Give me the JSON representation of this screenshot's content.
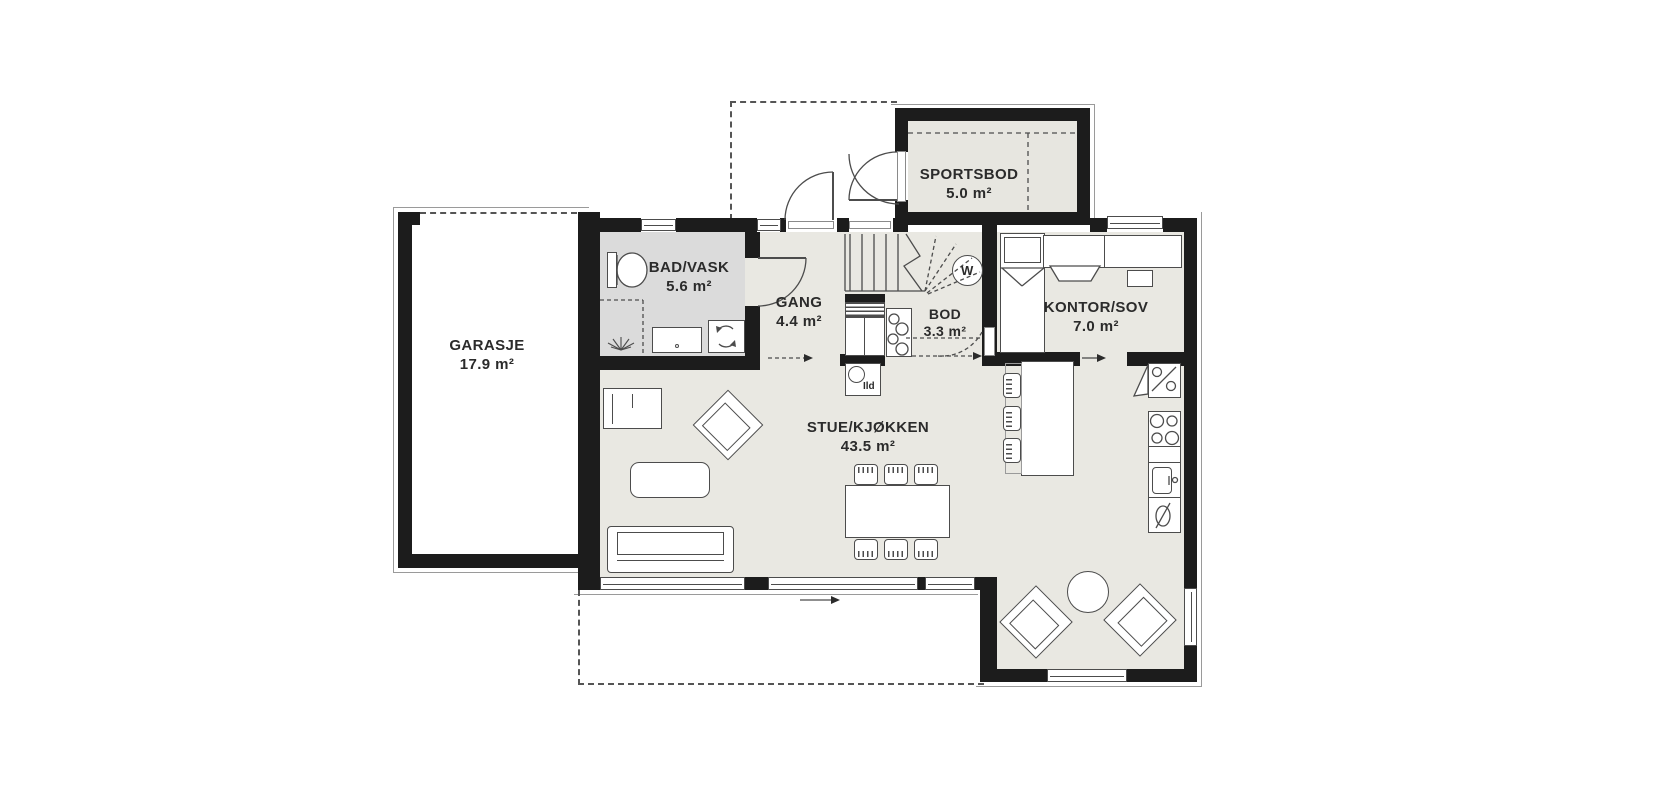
{
  "plan": {
    "title": "floor-plan-first-floor",
    "rooms": [
      {
        "key": "garasje",
        "name": "GARASJE",
        "area": "17.9 m²"
      },
      {
        "key": "sportsbod",
        "name": "SPORTSBOD",
        "area": "5.0 m²"
      },
      {
        "key": "bad_vask",
        "name": "BAD/VASK",
        "area": "5.6 m²"
      },
      {
        "key": "gang",
        "name": "GANG",
        "area": "4.4 m²"
      },
      {
        "key": "bod",
        "name": "BOD",
        "area": "3.3 m²"
      },
      {
        "key": "kontor_sov",
        "name": "KONTOR/SOV",
        "area": "7.0 m²"
      },
      {
        "key": "stue_kjokken",
        "name": "STUE/KJØKKEN",
        "area": "43.5 m²"
      }
    ],
    "annotations": {
      "fireplace": "Ild",
      "water_heater": "W"
    },
    "colors": {
      "wall": "#1c1c1c",
      "floor": "#e9e8e2",
      "bathroom_floor": "#dbdbdb",
      "storage_floor": "#e7e6e0",
      "line": "#4c4c4c"
    }
  }
}
